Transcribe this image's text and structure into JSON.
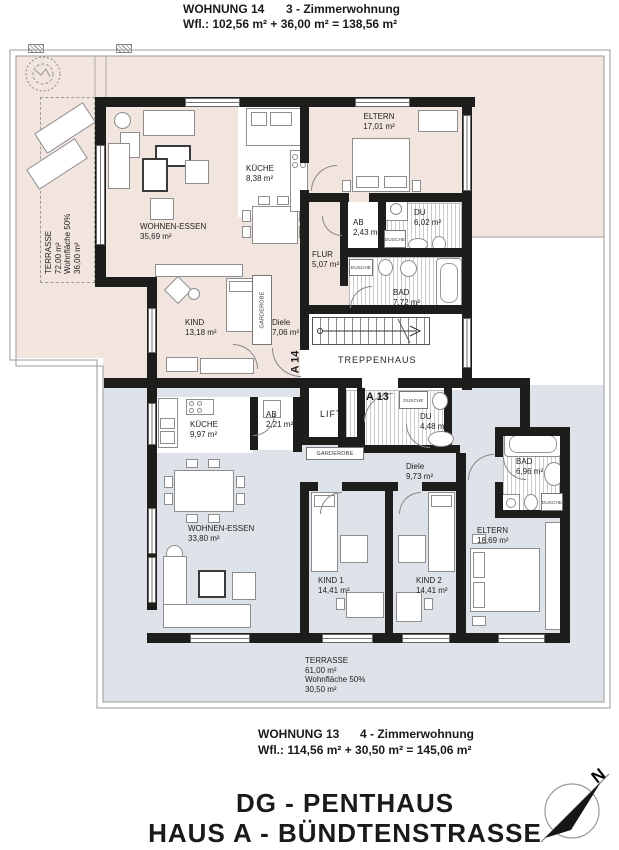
{
  "header": {
    "apt": "WOHNUNG 14",
    "type": "3 - Zimmerwohnung",
    "area": "Wfl.:  102,56 m² + 36,00 m² = 138,56 m²"
  },
  "footer": {
    "apt": "WOHNUNG 13",
    "type": "4 - Zimmerwohnung",
    "area": "Wfl.:  114,56 m² + 30,50 m² = 145,06 m²"
  },
  "titles": {
    "line1": "DG - PENTHAUS",
    "line2": "HAUS A - BÜNDTENSTRASSE"
  },
  "compass": {
    "north": "N"
  },
  "core": {
    "stairs": "TREPPENHAUS",
    "lift": "LIFT",
    "door_w14": "A 14",
    "door_w13": "A 13"
  },
  "w14": {
    "terrasse": {
      "name": "TERRASSE",
      "l1": "72,00 m²",
      "l2": "Wohnfläche 50%",
      "l3": "36,00 m²"
    },
    "wohnen": {
      "name": "WOHNEN-ESSEN",
      "area": "35,69 m²"
    },
    "kueche": {
      "name": "KÜCHE",
      "area": "8,38 m²"
    },
    "eltern": {
      "name": "ELTERN",
      "area": "17,01 m²"
    },
    "ab": {
      "name": "AB",
      "area": "2,43 m²"
    },
    "du": {
      "name": "DU",
      "area": "6,02 m²"
    },
    "flur": {
      "name": "FLUR",
      "area": "5,07 m²"
    },
    "bad": {
      "name": "BAD",
      "area": "7,72 m²"
    },
    "kind": {
      "name": "KIND",
      "area": "13,18 m²"
    },
    "diele": {
      "name": "Diele",
      "area": "7,06 m²"
    },
    "garderobe": "GARDEROBE",
    "dusche": "DUSCHE"
  },
  "w13": {
    "terrasse": {
      "name": "TERRASSE",
      "l1": "61,00 m²",
      "l2": "Wohnfläche 50%",
      "l3": "30,50 m²"
    },
    "kueche": {
      "name": "KÜCHE",
      "area": "9,97 m²"
    },
    "ab": {
      "name": "AB",
      "area": "2,21 m²"
    },
    "wohnen": {
      "name": "WOHNEN-ESSEN",
      "area": "33,80 m²"
    },
    "du": {
      "name": "DU",
      "area": "4,48 m²"
    },
    "diele": {
      "name": "Diele",
      "area": "9,73 m²"
    },
    "bad": {
      "name": "BAD",
      "area": "6,96 m²"
    },
    "eltern": {
      "name": "ELTERN",
      "area": "18,69 m²"
    },
    "kind1": {
      "name": "KIND 1",
      "area": "14,41 m²"
    },
    "kind2": {
      "name": "KIND 2",
      "area": "14,41 m²"
    },
    "garderobe": "GARDEROBE",
    "dusche": "DUSCHE"
  },
  "colors": {
    "pink": "#f2e4df",
    "blue": "#dee3ea",
    "wall": "#1d1d1b"
  }
}
